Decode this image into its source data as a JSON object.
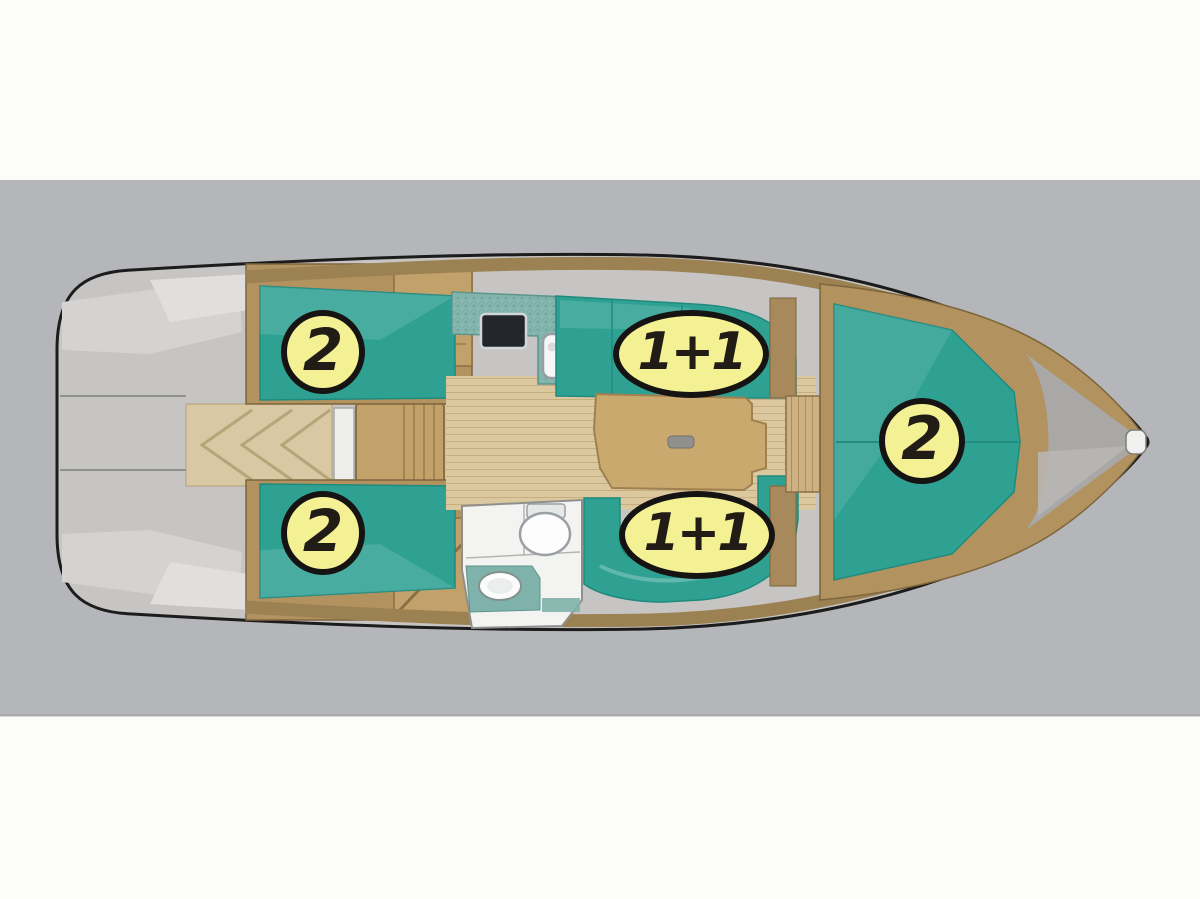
{
  "diagram": {
    "type": "boat-deck-plan",
    "subject": "sailing yacht interior layout, top view, bow pointing right",
    "badges": [
      {
        "id": "aft-cabin-port",
        "label": "2",
        "shape": "circle",
        "meaning": "berth count aft port cabin"
      },
      {
        "id": "aft-cabin-starboard",
        "label": "2",
        "shape": "circle",
        "meaning": "berth count aft starboard cabin"
      },
      {
        "id": "saloon-settee-port",
        "label": "1+1",
        "shape": "ellipse",
        "meaning": "berth count port saloon settee"
      },
      {
        "id": "saloon-settee-starboard",
        "label": "1+1",
        "shape": "ellipse",
        "meaning": "berth count starboard saloon settee"
      },
      {
        "id": "forward-cabin",
        "label": "2",
        "shape": "circle",
        "meaning": "berth count forward V-berth"
      }
    ],
    "colors": {
      "page_background": "#fcfcfb",
      "gray_band": "#b5b6b9",
      "hull_gray": "#c6c5c3",
      "bow_locker_gray": "#a9a8a6",
      "upholstery_teal": "#2fa193",
      "teal_dark_edge": "#1f8a7e",
      "galley_counter_teal": "#83b4ac",
      "wood_floor_light": "#dbc89f",
      "wood_mid": "#c3a16b",
      "wood_deck_band": "#9c8253",
      "wood_dark_edge": "#7d653c",
      "badge_fill": "#f4f195",
      "badge_border": "#161412",
      "badge_text": "#221c16",
      "stove_black": "#23272c",
      "fixture_white": "#f4f4f2"
    }
  }
}
